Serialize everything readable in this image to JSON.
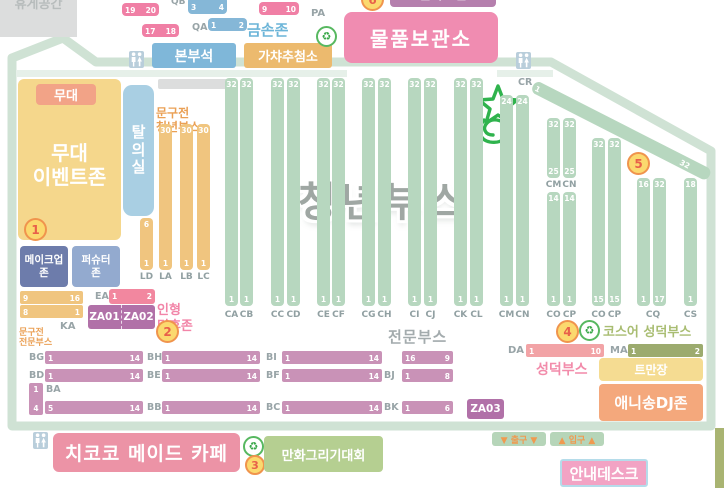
{
  "rest_area_label": "휴게공간",
  "top": {
    "pa_label": "PA",
    "qa_label": "QA",
    "qb_label": "QB",
    "pa19": "19",
    "pa20": "20",
    "pa17": "17",
    "pa18": "18",
    "pa9": "9",
    "pa10": "10",
    "qb3": "3",
    "qb4": "4",
    "qa1": "1",
    "qa2": "2",
    "gold_hands_zone": "금손존",
    "hq": "본부석",
    "gacha_draw": "가챠추첨소",
    "storage": "물품보관소",
    "clipped_sign": "팔아드림",
    "clipped_circle_num": "6"
  },
  "stage": {
    "stage_label": "무대",
    "event_zone": "무대\n이벤트존",
    "circle1": "1"
  },
  "left": {
    "makeup_zone": "메이크업\n존",
    "pershooter_zone": "퍼슈터\n존",
    "dressing_room": "탈\n의\n실",
    "stationery_youth": "문구전\n청년부스",
    "stationery_pro": "문구전\n전문부스",
    "ka_label": "KA",
    "bar_a": {
      "l": "9",
      "r": "16"
    },
    "bar_b": {
      "l": "8",
      "r": "1"
    },
    "ea_label": "EA",
    "ea_bar": {
      "l": "1",
      "r": "2"
    },
    "za01": "ZA01",
    "za02": "ZA02",
    "doll_fan_zone": "인형\n덕후존",
    "circle2": "2"
  },
  "center": {
    "youth_booth_title": "청년부스",
    "circle5": "5",
    "cr_label": "CR",
    "cr_bar": {
      "l": "1",
      "r": "32"
    }
  },
  "youth_columns": [
    {
      "label": "CA",
      "x": 225,
      "y": 78,
      "h": 228,
      "top": "32",
      "bot": "1",
      "ly": 310
    },
    {
      "label": "CB",
      "x": 240,
      "y": 78,
      "h": 228,
      "top": "32",
      "bot": "1",
      "ly": 310
    },
    {
      "label": "CC",
      "x": 271,
      "y": 78,
      "h": 228,
      "top": "32",
      "bot": "1",
      "ly": 310
    },
    {
      "label": "CD",
      "x": 287,
      "y": 78,
      "h": 228,
      "top": "32",
      "bot": "1",
      "ly": 310
    },
    {
      "label": "CE",
      "x": 317,
      "y": 78,
      "h": 228,
      "top": "32",
      "bot": "1",
      "ly": 310
    },
    {
      "label": "CF",
      "x": 332,
      "y": 78,
      "h": 228,
      "top": "32",
      "bot": "1",
      "ly": 310
    },
    {
      "label": "CG",
      "x": 362,
      "y": 78,
      "h": 228,
      "top": "32",
      "bot": "1",
      "ly": 310
    },
    {
      "label": "CH",
      "x": 378,
      "y": 78,
      "h": 228,
      "top": "32",
      "bot": "1",
      "ly": 310
    },
    {
      "label": "CI",
      "x": 408,
      "y": 78,
      "h": 228,
      "top": "32",
      "bot": "1",
      "ly": 310
    },
    {
      "label": "CJ",
      "x": 424,
      "y": 78,
      "h": 228,
      "top": "32",
      "bot": "1",
      "ly": 310
    },
    {
      "label": "CK",
      "x": 454,
      "y": 78,
      "h": 228,
      "top": "32",
      "bot": "1",
      "ly": 310
    },
    {
      "label": "CL",
      "x": 470,
      "y": 78,
      "h": 228,
      "top": "32",
      "bot": "1",
      "ly": 310
    },
    {
      "label": "CM",
      "x": 500,
      "y": 95,
      "h": 211,
      "top": "24",
      "bot": "1",
      "ly": 310
    },
    {
      "label": "CN",
      "x": 516,
      "y": 95,
      "h": 211,
      "top": "24",
      "bot": "1",
      "ly": 310
    },
    {
      "label": "CM",
      "x": 547,
      "y": 118,
      "h": 60,
      "top": "32",
      "bot": "25",
      "ly": 180
    },
    {
      "label": "CN",
      "x": 563,
      "y": 118,
      "h": 60,
      "top": "32",
      "bot": "25",
      "ly": 180
    },
    {
      "label": "CO",
      "x": 547,
      "y": 192,
      "h": 114,
      "top": "14",
      "bot": "1",
      "ly": 310
    },
    {
      "label": "CP",
      "x": 563,
      "y": 192,
      "h": 114,
      "top": "14",
      "bot": "1",
      "ly": 310
    },
    {
      "label": "CO",
      "x": 592,
      "y": 138,
      "h": 168,
      "top": "32",
      "bot": "15",
      "ly": 310
    },
    {
      "label": "CP",
      "x": 608,
      "y": 138,
      "h": 168,
      "top": "32",
      "bot": "15",
      "ly": 310
    },
    {
      "label": "CQ",
      "x": 637,
      "y": 178,
      "h": 128,
      "top": "16",
      "bot": "1",
      "ly": 310,
      "lx": 639,
      "lw": 28
    },
    {
      "label": "",
      "x": 653,
      "y": 178,
      "h": 128,
      "top": "32",
      "bot": "17",
      "ly": 310
    },
    {
      "label": "CS",
      "x": 684,
      "y": 178,
      "h": 128,
      "top": "18",
      "bot": "1",
      "ly": 310
    }
  ],
  "stationery_columns": [
    {
      "label": "LD",
      "x": 140,
      "y": 218,
      "h": 52,
      "top": "6",
      "bot": "1",
      "ly": 272
    },
    {
      "label": "LA",
      "x": 159,
      "y": 124,
      "h": 146,
      "top": "30",
      "bot": "1",
      "ly": 272
    },
    {
      "label": "LB",
      "x": 180,
      "y": 124,
      "h": 146,
      "top": "30",
      "bot": "1",
      "ly": 272
    },
    {
      "label": "LC",
      "x": 197,
      "y": 124,
      "h": 146,
      "top": "30",
      "bot": "1",
      "ly": 272
    }
  ],
  "pro": {
    "title": "전문부스",
    "ba_label": "BA",
    "ba_bar": {
      "top": "1",
      "bot": "4"
    },
    "bars": [
      {
        "label": "BG",
        "lx": 29,
        "x": 45,
        "y": 351,
        "w": 98,
        "l": "1",
        "r": "14"
      },
      {
        "label": "BH",
        "lx": 147,
        "x": 162,
        "y": 351,
        "w": 98,
        "l": "1",
        "r": "14"
      },
      {
        "label": "BI",
        "lx": 266,
        "x": 282,
        "y": 351,
        "w": 100,
        "l": "1",
        "r": "14"
      },
      {
        "label": "",
        "x": 402,
        "y": 351,
        "w": 51,
        "l": "16",
        "r": "9"
      },
      {
        "label": "BD",
        "lx": 29,
        "x": 45,
        "y": 369,
        "w": 98,
        "l": "1",
        "r": "14"
      },
      {
        "label": "BE",
        "lx": 147,
        "x": 162,
        "y": 369,
        "w": 98,
        "l": "1",
        "r": "14"
      },
      {
        "label": "BF",
        "lx": 266,
        "x": 282,
        "y": 369,
        "w": 100,
        "l": "1",
        "r": "14"
      },
      {
        "label": "BJ",
        "lx": 384,
        "x": 402,
        "y": 369,
        "w": 51,
        "l": "1",
        "r": "8"
      },
      {
        "label": "",
        "x": 45,
        "y": 401,
        "w": 98,
        "l": "5",
        "r": "14"
      },
      {
        "label": "BB",
        "lx": 147,
        "x": 162,
        "y": 401,
        "w": 98,
        "l": "1",
        "r": "14"
      },
      {
        "label": "BC",
        "lx": 266,
        "x": 282,
        "y": 401,
        "w": 100,
        "l": "1",
        "r": "14"
      },
      {
        "label": "BK",
        "lx": 384,
        "x": 402,
        "y": 401,
        "w": 51,
        "l": "1",
        "r": "6"
      }
    ],
    "za03": "ZA03"
  },
  "right": {
    "circle4": "4",
    "cosplayer_booth": "코스어 성덕부스",
    "da_label": "DA",
    "da_bar": {
      "l": "1",
      "r": "10"
    },
    "ma_label": "MA",
    "ma_bar": {
      "l": "1",
      "r": "2"
    },
    "seongdeok_booth": "성덕부스",
    "twitter_meetup": "트만장",
    "anisong_dj_zone": "애니송DJ존"
  },
  "bottom": {
    "exit_sign": "▼ 출구 ▼",
    "entrance_sign": "▲ 입구 ▲",
    "info_desk": "안내데스크",
    "maid_cafe": "치코코 메이드 카페",
    "cartoon_contest": "만화그리기대회",
    "circle3": "3"
  }
}
